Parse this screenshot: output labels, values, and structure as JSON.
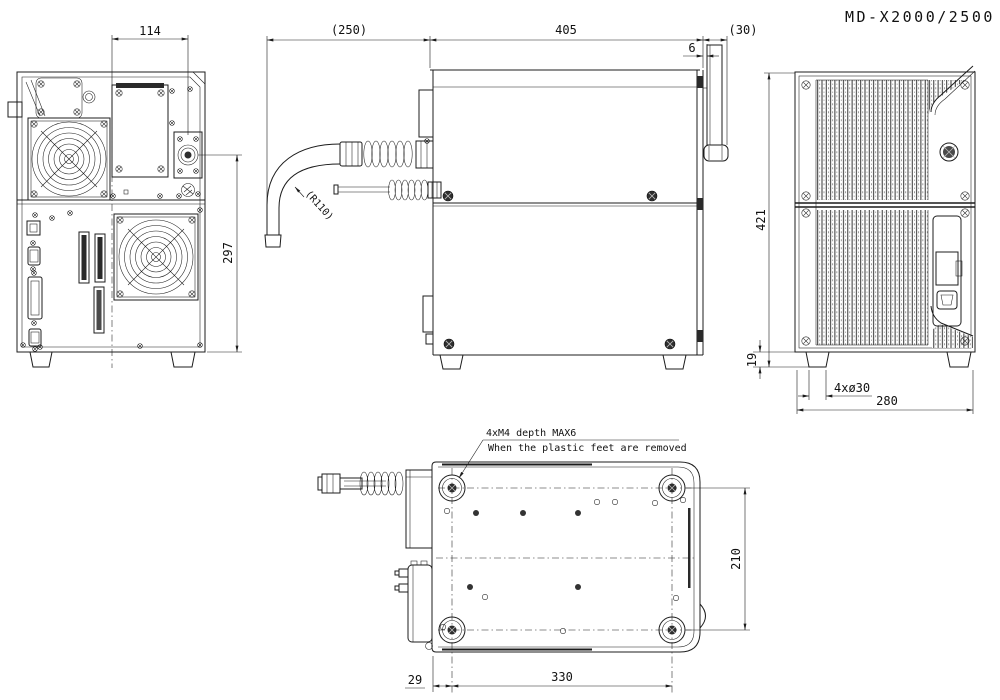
{
  "title": "MD-X2000/2500",
  "views": {
    "rear": {
      "dim_top_width": "114",
      "dim_right_height": "297"
    },
    "side": {
      "dim_cable_clearance": "(250)",
      "dim_body_depth": "405",
      "dim_cover_gap": "6",
      "dim_handle_depth": "(30)",
      "label_cable_radius": "(R110)"
    },
    "front": {
      "dim_total_height": "421",
      "dim_foot_height": "19",
      "label_feet": "4xø30",
      "dim_body_width": "280"
    },
    "bottom": {
      "dim_foot_offset": "29",
      "dim_feet_pitch_x": "330",
      "dim_feet_pitch_y": "210",
      "note_tap": "4xM4 depth MAX6",
      "note_condition": "When the plastic feet are removed"
    }
  },
  "colors": {
    "line": "#1c1c1c",
    "background": "#ffffff"
  }
}
